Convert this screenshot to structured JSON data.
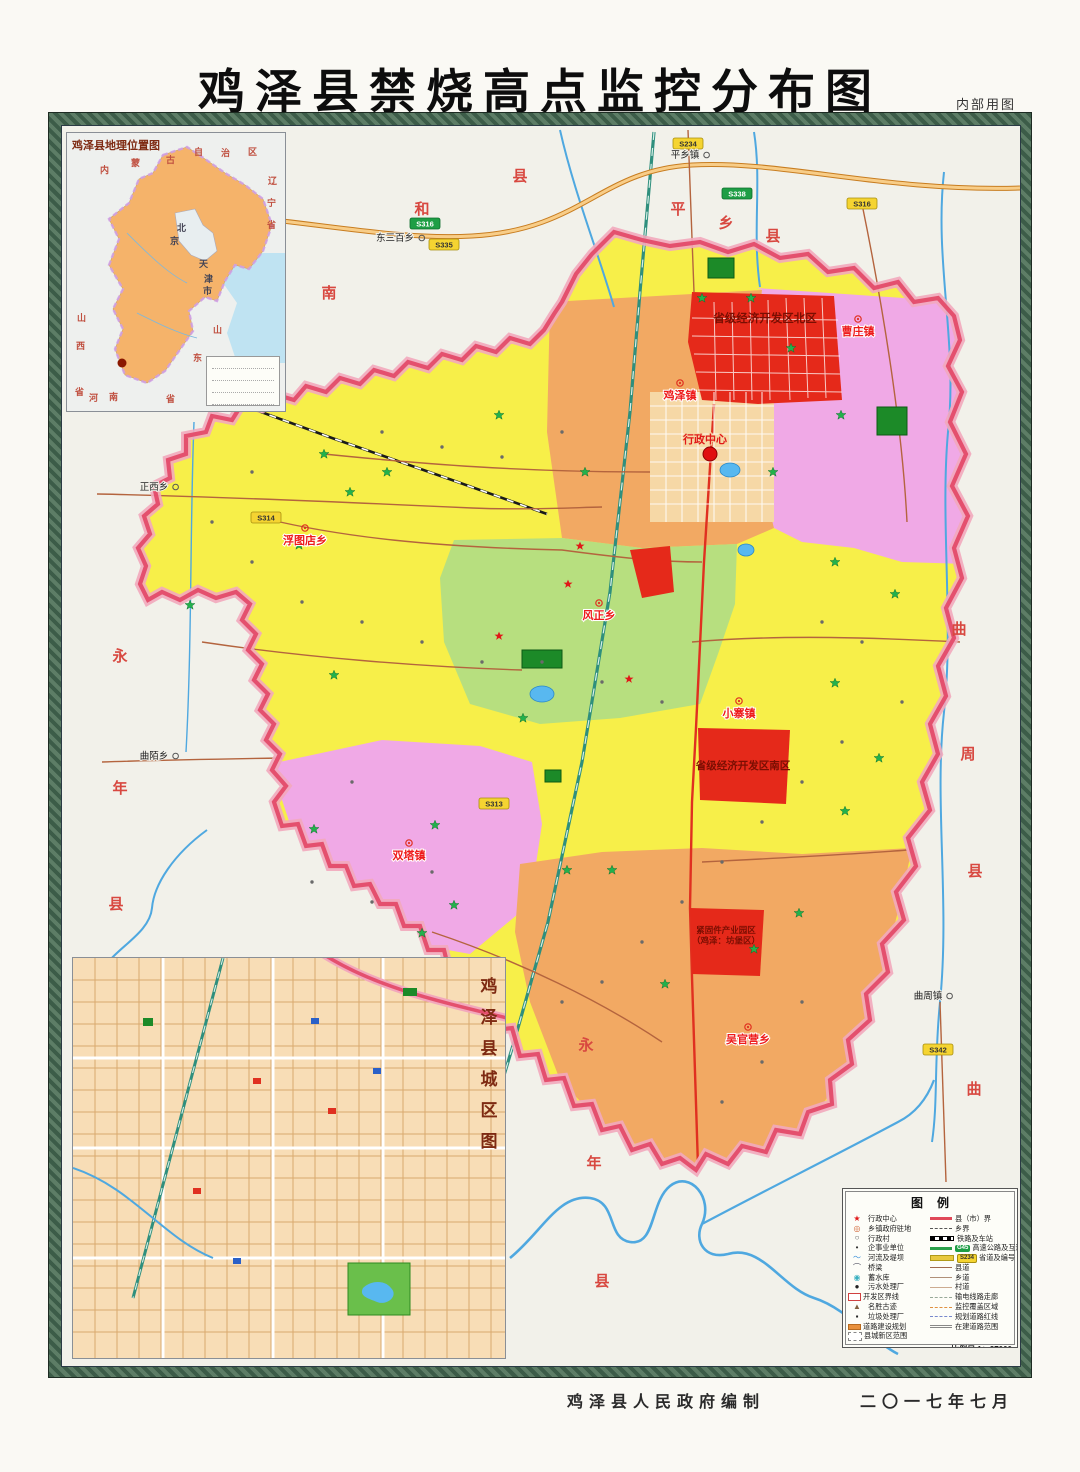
{
  "page": {
    "title": "鸡泽县禁烧高点监控分布图",
    "note": "内部用图",
    "credit": "鸡泽县人民政府编制",
    "date": "二〇一七年七月"
  },
  "colors": {
    "county_border": "#e4506e",
    "yellow": "#f7ef49",
    "orange": "#f2a963",
    "pink": "#f0a9e6",
    "green": "#b7df7f",
    "red_zone": "#e5291a",
    "river": "#4fa8e0",
    "expressway": "#e89a40",
    "railway": "#2f8f7d",
    "road": "#b4643e",
    "badge_yellow": "#f5d431",
    "badge_green": "#1e9e45",
    "monitor_star": "#22b14c"
  },
  "location_inset": {
    "title": "鸡泽县地理位置图",
    "marker_name": "鸡泽县",
    "chars": [
      {
        "t": "内",
        "x": 33,
        "y": 30
      },
      {
        "t": "蒙",
        "x": 64,
        "y": 23
      },
      {
        "t": "古",
        "x": 99,
        "y": 20
      },
      {
        "t": "自",
        "x": 127,
        "y": 12
      },
      {
        "t": "治",
        "x": 154,
        "y": 13
      },
      {
        "t": "区",
        "x": 181,
        "y": 12
      },
      {
        "t": "辽",
        "x": 201,
        "y": 41
      },
      {
        "t": "宁",
        "x": 200,
        "y": 63
      },
      {
        "t": "省",
        "x": 200,
        "y": 85
      },
      {
        "t": "山",
        "x": 10,
        "y": 178
      },
      {
        "t": "西",
        "x": 9,
        "y": 206
      },
      {
        "t": "省",
        "x": 8,
        "y": 252
      },
      {
        "t": "河",
        "x": 22,
        "y": 258
      },
      {
        "t": "南",
        "x": 42,
        "y": 257
      },
      {
        "t": "省",
        "x": 99,
        "y": 259
      },
      {
        "t": "山",
        "x": 146,
        "y": 190
      },
      {
        "t": "东",
        "x": 126,
        "y": 218
      },
      {
        "t": "北",
        "x": 110,
        "y": 88,
        "k": "blk"
      },
      {
        "t": "京",
        "x": 103,
        "y": 101,
        "k": "blk"
      },
      {
        "t": "天",
        "x": 132,
        "y": 124,
        "k": "blk"
      },
      {
        "t": "津",
        "x": 137,
        "y": 139,
        "k": "blk"
      },
      {
        "t": "市",
        "x": 136,
        "y": 151,
        "k": "blk"
      }
    ]
  },
  "city_inset": {
    "title_chars": [
      "鸡",
      "泽",
      "县",
      "城",
      "区",
      "图"
    ]
  },
  "legend": {
    "title": "图例",
    "left": [
      {
        "glyph": "★",
        "color": "#e01818",
        "label": "行政中心"
      },
      {
        "glyph": "◎",
        "color": "#d06030",
        "label": "乡镇政府驻地"
      },
      {
        "glyph": "○",
        "color": "#555555",
        "label": "行政村"
      },
      {
        "glyph": "•",
        "color": "#333333",
        "label": "企事业单位"
      },
      {
        "glyph": "〜",
        "color": "#3a90d8",
        "label": "河流及堤坝"
      },
      {
        "glyph": "⌒",
        "color": "#556",
        "label": "桥梁"
      },
      {
        "glyph": "◉",
        "color": "#3ab0c0",
        "label": "蓄水库"
      },
      {
        "glyph": "●",
        "color": "#222222",
        "label": "污水处理厂"
      },
      {
        "shape": "box-red",
        "label": "开发区界线"
      },
      {
        "glyph": "▲",
        "color": "#806040",
        "label": "名胜古迹"
      },
      {
        "glyph": "▪",
        "color": "#222222",
        "label": "垃圾处理厂"
      },
      {
        "shape": "bar-orange",
        "label": "道路建设规划"
      },
      {
        "shape": "box-dashed",
        "label": "县城新区范围"
      }
    ],
    "right": [
      {
        "line": "thickred",
        "label": "县（市）界"
      },
      {
        "line": "dashdot",
        "label": "乡界"
      },
      {
        "line": "rail",
        "label": "铁路及车站"
      },
      {
        "line": "green",
        "badge": "G45",
        "badge_k": "g",
        "label": "高速公路及互通"
      },
      {
        "line": "yellow",
        "badge": "S234",
        "badge_k": "y",
        "label": "省道及编号"
      },
      {
        "line": "solid",
        "label": "县道"
      },
      {
        "line": "thin",
        "label": "乡道"
      },
      {
        "line": "thinner",
        "label": "村道"
      },
      {
        "line": "dashgray",
        "label": "输电线路走廊"
      },
      {
        "line": "dashorange",
        "label": "监控覆盖区域"
      },
      {
        "line": "dashblue",
        "label": "规划道路红线"
      },
      {
        "line": "dashdbl",
        "label": "在建道路范围"
      }
    ],
    "scale": "比例尺 1：37000",
    "note": "注：本图界线不作为划界依据"
  },
  "map": {
    "admin_center": {
      "label": "行政中心",
      "x": 703,
      "y": 441,
      "dot_x": 708,
      "dot_y": 452
    },
    "townships": [
      {
        "name": "鸡泽镇",
        "x": 678,
        "y": 397
      },
      {
        "name": "曹庄镇",
        "x": 856,
        "y": 333
      },
      {
        "name": "浮图店乡",
        "x": 303,
        "y": 542
      },
      {
        "name": "风正乡",
        "x": 597,
        "y": 617
      },
      {
        "name": "小寨镇",
        "x": 737,
        "y": 715
      },
      {
        "name": "双塔镇",
        "x": 407,
        "y": 857
      },
      {
        "name": "吴官营乡",
        "x": 746,
        "y": 1041
      }
    ],
    "zones": [
      {
        "lines": [
          "省级经济开发区北区"
        ],
        "x": 763,
        "y": 320,
        "size": 11.5
      },
      {
        "lines": [
          "省级经济开发区南区"
        ],
        "x": 741,
        "y": 767,
        "size": 10.5
      },
      {
        "lines": [
          "紧固件产业园区",
          "（鸡泽：坊堡区）"
        ],
        "x": 724,
        "y": 931,
        "size": 8.5
      }
    ],
    "neighbors": [
      {
        "t": "南",
        "x": 327,
        "y": 296
      },
      {
        "t": "和",
        "x": 420,
        "y": 212
      },
      {
        "t": "县",
        "x": 518,
        "y": 179
      },
      {
        "t": "平",
        "x": 676,
        "y": 212
      },
      {
        "t": "乡",
        "x": 724,
        "y": 226
      },
      {
        "t": "县",
        "x": 771,
        "y": 239
      },
      {
        "t": "曲",
        "x": 957,
        "y": 632
      },
      {
        "t": "周",
        "x": 966,
        "y": 757
      },
      {
        "t": "县",
        "x": 973,
        "y": 874
      },
      {
        "t": "永",
        "x": 118,
        "y": 659
      },
      {
        "t": "年",
        "x": 118,
        "y": 791
      },
      {
        "t": "县",
        "x": 114,
        "y": 907
      },
      {
        "t": "永",
        "x": 584,
        "y": 1048
      },
      {
        "t": "年",
        "x": 592,
        "y": 1166
      },
      {
        "t": "县",
        "x": 600,
        "y": 1284
      },
      {
        "t": "曲",
        "x": 972,
        "y": 1092
      },
      {
        "t": "周",
        "x": 979,
        "y": 1214
      },
      {
        "t": "县",
        "x": 986,
        "y": 1336
      }
    ],
    "ext_towns": [
      {
        "name": "平乡镇",
        "x": 683,
        "y": 156
      },
      {
        "name": "东三百乡",
        "x": 393,
        "y": 239
      },
      {
        "name": "正西乡",
        "x": 152,
        "y": 488
      },
      {
        "name": "曲陌乡",
        "x": 152,
        "y": 757
      },
      {
        "name": "曲周镇",
        "x": 926,
        "y": 997
      }
    ],
    "badges": [
      {
        "t": "S316",
        "k": "g",
        "x": 423,
        "y": 222
      },
      {
        "t": "S338",
        "k": "g",
        "x": 735,
        "y": 192
      },
      {
        "t": "S335",
        "k": "y",
        "x": 442,
        "y": 243
      },
      {
        "t": "S316",
        "k": "y",
        "x": 860,
        "y": 202
      },
      {
        "t": "S314",
        "k": "y",
        "x": 264,
        "y": 516
      },
      {
        "t": "S234",
        "k": "y",
        "x": 686,
        "y": 142
      },
      {
        "t": "S342",
        "k": "y",
        "x": 936,
        "y": 1048
      },
      {
        "t": "S313",
        "k": "y",
        "x": 492,
        "y": 802
      }
    ],
    "monitor_points": [
      [
        322,
        452
      ],
      [
        348,
        490
      ],
      [
        385,
        470
      ],
      [
        297,
        543
      ],
      [
        188,
        603
      ],
      [
        332,
        673
      ],
      [
        312,
        827
      ],
      [
        433,
        823
      ],
      [
        452,
        903
      ],
      [
        420,
        931
      ],
      [
        521,
        716
      ],
      [
        565,
        868
      ],
      [
        610,
        868
      ],
      [
        663,
        982
      ],
      [
        752,
        947
      ],
      [
        797,
        911
      ],
      [
        843,
        809
      ],
      [
        877,
        756
      ],
      [
        833,
        681
      ],
      [
        893,
        592
      ],
      [
        833,
        560
      ],
      [
        771,
        470
      ],
      [
        700,
        296
      ],
      [
        749,
        296
      ],
      [
        789,
        346
      ],
      [
        839,
        413
      ],
      [
        497,
        413
      ],
      [
        583,
        470
      ]
    ],
    "red_stars": [
      [
        578,
        544
      ],
      [
        566,
        582
      ],
      [
        497,
        634
      ],
      [
        627,
        677
      ]
    ],
    "village_dots": [
      [
        380,
        430
      ],
      [
        440,
        445
      ],
      [
        500,
        455
      ],
      [
        560,
        430
      ],
      [
        250,
        470
      ],
      [
        210,
        520
      ],
      [
        250,
        560
      ],
      [
        300,
        600
      ],
      [
        360,
        620
      ],
      [
        420,
        640
      ],
      [
        480,
        660
      ],
      [
        540,
        660
      ],
      [
        600,
        680
      ],
      [
        660,
        700
      ],
      [
        820,
        620
      ],
      [
        860,
        640
      ],
      [
        900,
        700
      ],
      [
        840,
        740
      ],
      [
        800,
        780
      ],
      [
        760,
        820
      ],
      [
        720,
        860
      ],
      [
        680,
        900
      ],
      [
        640,
        940
      ],
      [
        600,
        980
      ],
      [
        560,
        1000
      ],
      [
        760,
        1060
      ],
      [
        800,
        1000
      ],
      [
        720,
        1100
      ],
      [
        350,
        780
      ],
      [
        310,
        880
      ],
      [
        370,
        900
      ],
      [
        430,
        870
      ]
    ]
  }
}
